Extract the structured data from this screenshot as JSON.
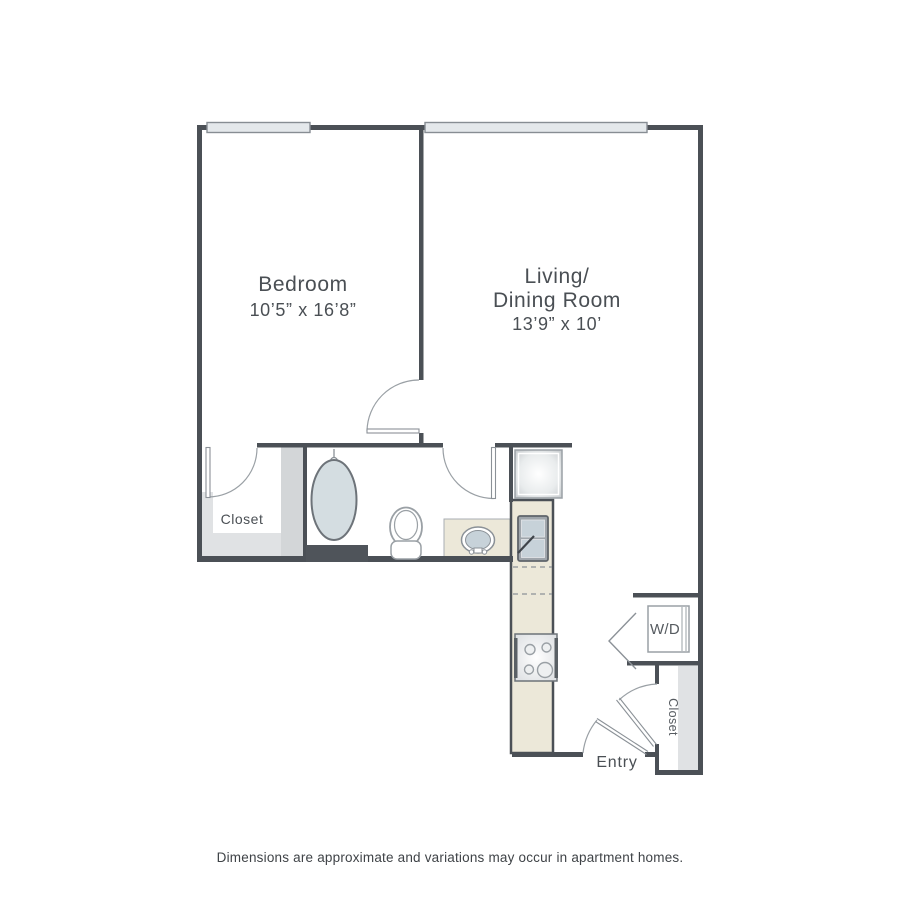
{
  "floorplan": {
    "rooms": {
      "bedroom": {
        "name": "Bedroom",
        "dimensions": "10’5” x 16’8”"
      },
      "living_dining": {
        "name_line1": "Living/",
        "name_line2": "Dining Room",
        "dimensions": "13’9” x 10’"
      },
      "hall_closet": {
        "name": "Closet"
      },
      "entry_closet": {
        "name": "Closet"
      },
      "washer_dryer": {
        "label": "W/D"
      },
      "entry": {
        "label": "Entry"
      }
    },
    "disclaimer": "Dimensions are approximate and variations may occur in apartment homes.",
    "colors": {
      "wall": "#4b5056",
      "fixture_outline": "#8b9197",
      "window_fill": "#e4e8eb",
      "tub_fill": "#d4dde1",
      "basin_fill": "#c7d2d9",
      "counter_fill": "#ece8d9",
      "shelf_fill": "#e0e2e4",
      "label_text": "#4a4f54"
    }
  }
}
